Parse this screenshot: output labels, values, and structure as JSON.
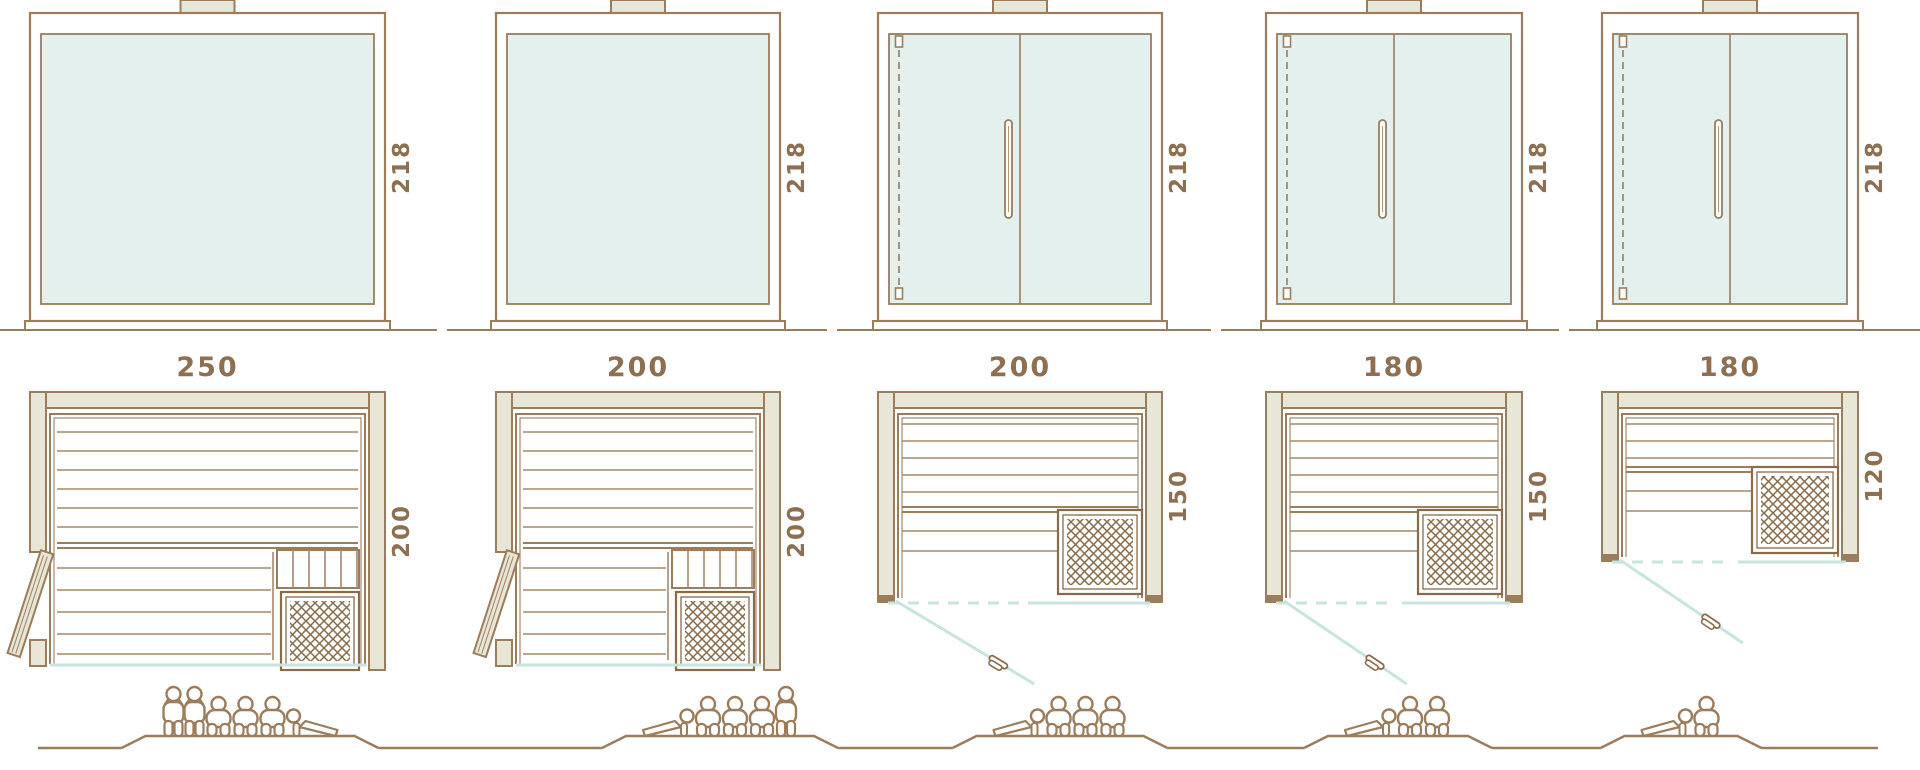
{
  "diagram": {
    "kind": "sauna-size-comparison",
    "height_unit_values": [
      "218",
      "218",
      "218",
      "218",
      "218"
    ]
  },
  "colors": {
    "line": "#9b7c5b",
    "line_dark": "#8a6b48",
    "line_thin": "#a6896a",
    "wood_fill": "#e8e6d6",
    "glass_fill": "#e3f0ed",
    "glass_line": "#c7e4df",
    "label": "#8d7052",
    "background": "#ffffff"
  },
  "models": [
    {
      "name": "sauna-250x200",
      "front": {
        "type": "fixed-glass",
        "width_cm": 250,
        "height_cm": 218,
        "height_label": "218"
      },
      "plan": {
        "type": "wood-door-left",
        "width_cm": 250,
        "depth_cm": 200,
        "width_label": "250",
        "depth_label": "200"
      },
      "capacity": {
        "total": 6,
        "figures": [
          "standing",
          "standing",
          "sitting",
          "sitting",
          "sitting",
          "lying-head-left"
        ]
      }
    },
    {
      "name": "sauna-200x200",
      "front": {
        "type": "fixed-glass",
        "width_cm": 200,
        "height_cm": 218,
        "height_label": "218"
      },
      "plan": {
        "type": "wood-door-left",
        "width_cm": 200,
        "depth_cm": 200,
        "width_label": "200",
        "depth_label": "200"
      },
      "capacity": {
        "total": 5,
        "figures": [
          "lying-head-right",
          "sitting",
          "sitting",
          "sitting",
          "standing"
        ]
      }
    },
    {
      "name": "sauna-200x150",
      "front": {
        "type": "double-glass-door",
        "width_cm": 200,
        "height_cm": 218,
        "height_label": "218"
      },
      "plan": {
        "type": "glass-front-door",
        "width_cm": 200,
        "depth_cm": 150,
        "width_label": "200",
        "depth_label": "150"
      },
      "capacity": {
        "total": 4,
        "figures": [
          "lying-head-right",
          "sitting",
          "sitting",
          "sitting"
        ]
      }
    },
    {
      "name": "sauna-180x150",
      "front": {
        "type": "double-glass-door",
        "width_cm": 180,
        "height_cm": 218,
        "height_label": "218"
      },
      "plan": {
        "type": "glass-front-door",
        "width_cm": 180,
        "depth_cm": 150,
        "width_label": "180",
        "depth_label": "150"
      },
      "capacity": {
        "total": 3,
        "figures": [
          "lying-head-right",
          "sitting",
          "sitting"
        ]
      }
    },
    {
      "name": "sauna-180x120",
      "front": {
        "type": "double-glass-door",
        "width_cm": 180,
        "height_cm": 218,
        "height_label": "218"
      },
      "plan": {
        "type": "glass-front-door",
        "width_cm": 180,
        "depth_cm": 120,
        "width_label": "180",
        "depth_label": "120"
      },
      "capacity": {
        "total": 2,
        "figures": [
          "lying-head-right",
          "sitting"
        ]
      }
    }
  ]
}
